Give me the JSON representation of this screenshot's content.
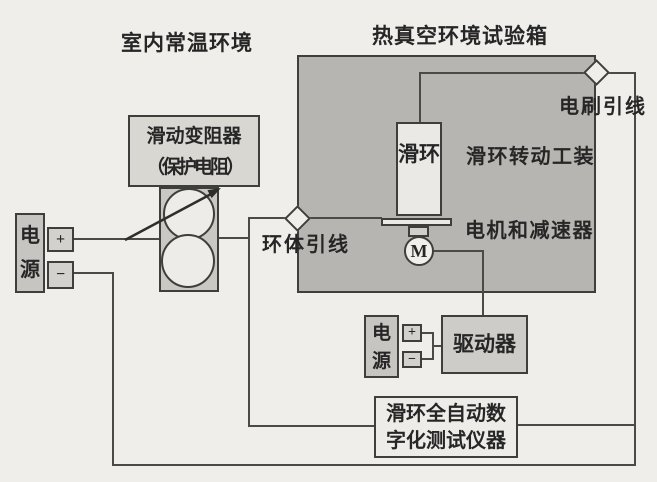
{
  "figure": {
    "type": "schematic-diagram",
    "description_labels": {
      "room_env": "室内常温环境",
      "chamber_title": "热真空环境试验箱",
      "brush_lead": "电刷引线",
      "ring_lead": "环体引线",
      "rotation_fixture": "滑环转动工装",
      "motor_reducer": "电机和减速器"
    },
    "components": {
      "rheostat": {
        "line1": "滑动变阻器",
        "line2": "（保护电阻）"
      },
      "psu_left": {
        "label": "电源",
        "plus": "+",
        "minus": "−"
      },
      "psu_right": {
        "label": "电源",
        "plus": "+",
        "minus": "−"
      },
      "slip_ring": {
        "label": "滑环"
      },
      "motor": {
        "label": "M"
      },
      "driver": {
        "label": "驱动器"
      },
      "tester": {
        "line1": "滑环全自动数",
        "line2": "字化测试仪器"
      }
    },
    "colors": {
      "paper": "#efeeea",
      "chamber_fill": "#b6b5b1",
      "line": "#4a4a48",
      "box_gray": "#c9c8c3",
      "box_light": "#eae9e5",
      "label_box_fill": "#d8d7d2"
    }
  }
}
